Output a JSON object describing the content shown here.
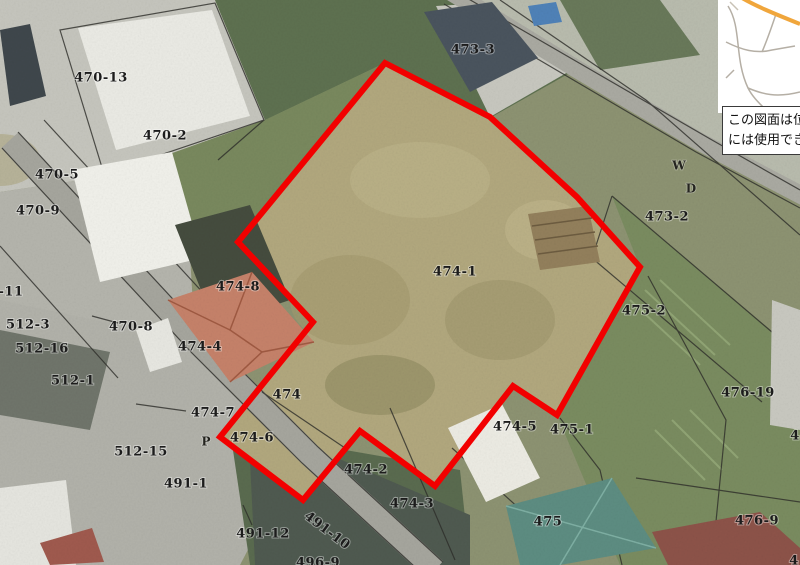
{
  "page": {
    "type": "cadastral-aerial-map-viewer",
    "width": 800,
    "height": 565
  },
  "colors": {
    "highlight_outline": "#f20000",
    "label_text": "#1c1c1c",
    "road_fill": "#a6a69e",
    "inset_road": "#b5afa5",
    "inset_highlight_road": "#f0a63c",
    "note_background": "#ffffff"
  },
  "highlight_parcel": {
    "id": "474-1",
    "stroke_width": 6,
    "outline_points": [
      [
        385,
        63
      ],
      [
        490,
        117
      ],
      [
        577,
        197
      ],
      [
        640,
        267
      ],
      [
        557,
        415
      ],
      [
        513,
        386
      ],
      [
        435,
        486
      ],
      [
        360,
        431
      ],
      [
        303,
        500
      ],
      [
        220,
        437
      ],
      [
        313,
        322
      ],
      [
        238,
        242
      ]
    ]
  },
  "parcel_labels": [
    {
      "text": "470-13",
      "x": 101,
      "y": 78
    },
    {
      "text": "470-2",
      "x": 165,
      "y": 136
    },
    {
      "text": "470-5",
      "x": 57,
      "y": 175
    },
    {
      "text": "470-9",
      "x": 38,
      "y": 211
    },
    {
      "text": "-11",
      "x": 11,
      "y": 292
    },
    {
      "text": "512-3",
      "x": 28,
      "y": 325
    },
    {
      "text": "512-16",
      "x": 42,
      "y": 349
    },
    {
      "text": "470-8",
      "x": 131,
      "y": 327
    },
    {
      "text": "512-1",
      "x": 73,
      "y": 381
    },
    {
      "text": "512-15",
      "x": 141,
      "y": 452
    },
    {
      "text": "491-1",
      "x": 186,
      "y": 484
    },
    {
      "text": "491-12",
      "x": 263,
      "y": 534
    },
    {
      "text": "491-10",
      "x": 327,
      "y": 531,
      "rot": 37
    },
    {
      "text": "496-9",
      "x": 318,
      "y": 563
    },
    {
      "text": "474-8",
      "x": 238,
      "y": 287
    },
    {
      "text": "474-4",
      "x": 200,
      "y": 347
    },
    {
      "text": "474-7",
      "x": 213,
      "y": 413
    },
    {
      "text": "474-6",
      "x": 252,
      "y": 438
    },
    {
      "text": "474",
      "x": 287,
      "y": 395
    },
    {
      "text": "474-2",
      "x": 366,
      "y": 470
    },
    {
      "text": "474-3",
      "x": 412,
      "y": 504
    },
    {
      "text": "474-1",
      "x": 455,
      "y": 272
    },
    {
      "text": "473-3",
      "x": 473,
      "y": 50
    },
    {
      "text": "473-2",
      "x": 667,
      "y": 217
    },
    {
      "text": "475-2",
      "x": 644,
      "y": 311
    },
    {
      "text": "474-5",
      "x": 515,
      "y": 427
    },
    {
      "text": "475-1",
      "x": 572,
      "y": 430
    },
    {
      "text": "475",
      "x": 548,
      "y": 522
    },
    {
      "text": "476-19",
      "x": 748,
      "y": 393
    },
    {
      "text": "476-9",
      "x": 757,
      "y": 521
    },
    {
      "text": "4",
      "x": 795,
      "y": 436
    },
    {
      "text": "4",
      "x": 794,
      "y": 561
    }
  ],
  "road_marks": [
    {
      "text": "W",
      "x": 679,
      "y": 166
    },
    {
      "text": "D",
      "x": 691,
      "y": 189
    },
    {
      "text": "P",
      "x": 206,
      "y": 442
    }
  ],
  "note": {
    "lines": [
      "この図面は位置",
      "には使用できま"
    ]
  }
}
